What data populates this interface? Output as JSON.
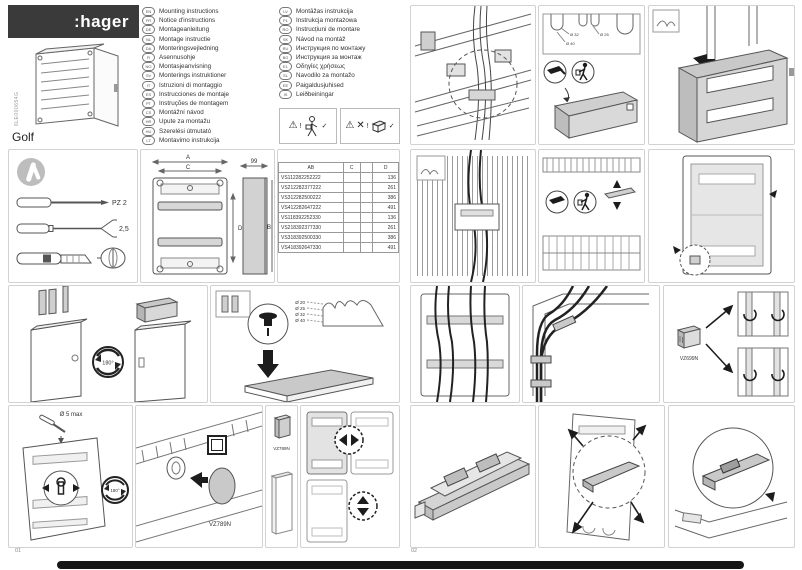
{
  "page": {
    "left_number": "01",
    "right_number": "02"
  },
  "brand": {
    "logo": ":hager",
    "product": "Golf",
    "doc_code": "6LE000654G"
  },
  "languages_col1": [
    {
      "code": "EN",
      "label": "Mounting instructions"
    },
    {
      "code": "FR",
      "label": "Notice d'instructions"
    },
    {
      "code": "DE",
      "label": "Montageanleitung"
    },
    {
      "code": "NL",
      "label": "Montage instructie"
    },
    {
      "code": "DA",
      "label": "Monteringsvejledning"
    },
    {
      "code": "FI",
      "label": "Asennusohje"
    },
    {
      "code": "NO",
      "label": "Montasjeanvisning"
    },
    {
      "code": "SV",
      "label": "Monterings instruktioner"
    },
    {
      "code": "IT",
      "label": "Istruzioni di montaggio"
    },
    {
      "code": "ES",
      "label": "Instrucciones de montaje"
    },
    {
      "code": "PT",
      "label": "Instruções de montagem"
    },
    {
      "code": "CS",
      "label": "Montážní návod"
    },
    {
      "code": "HR",
      "label": "Upute za montažu"
    },
    {
      "code": "HU",
      "label": "Szerelési útmutató"
    },
    {
      "code": "LT",
      "label": "Montavimo instrukcija"
    }
  ],
  "languages_col2": [
    {
      "code": "LV",
      "label": "Montāžas instrukcija"
    },
    {
      "code": "PL",
      "label": "Instrukcja montażowa"
    },
    {
      "code": "RO",
      "label": "Instrucțiuni de montare"
    },
    {
      "code": "SK",
      "label": "Návod na montáž"
    },
    {
      "code": "RU",
      "label": "Инструкция по монтажу"
    },
    {
      "code": "BG",
      "label": "Инструкция за монтаж"
    },
    {
      "code": "EL",
      "label": "Οδηγίες χρήσεως"
    },
    {
      "code": "SL",
      "label": "Navodilo za montažo"
    },
    {
      "code": "EE",
      "label": "Paigaldusjuhised"
    },
    {
      "code": "IS",
      "label": "Leiðbeiningar"
    }
  ],
  "warnings": {
    "triangle": "⚠",
    "check": "✓",
    "cross": "✕",
    "excl": "!"
  },
  "tools": {
    "pozidriv_label": "PZ 2",
    "flat_label": "2,5"
  },
  "dimensions": {
    "a": "A",
    "b": "B",
    "c": "C",
    "d": "D",
    "depth": "99"
  },
  "table": {
    "headers": {
      "col1": "AB",
      "col2": "C",
      "col3": "",
      "col4": "D"
    },
    "rows": [
      {
        "ref": "VS112282252222",
        "c": "",
        "d": "136"
      },
      {
        "ref": "VS212282377222",
        "c": "",
        "d": "261"
      },
      {
        "ref": "VS312282500222",
        "c": "",
        "d": "386"
      },
      {
        "ref": "VS412282647222",
        "c": "",
        "d": "491"
      },
      {
        "ref": "VS118392252330",
        "c": "",
        "d": "136"
      },
      {
        "ref": "VS218392377330",
        "c": "",
        "d": "261"
      },
      {
        "ref": "VS318392500330",
        "c": "",
        "d": "386"
      },
      {
        "ref": "VS418392647330",
        "c": "",
        "d": "491"
      }
    ]
  },
  "steps": {
    "rotate_label": "180°",
    "drill_label": "Ø 5 max",
    "accessory_vz789n": "VZ789N",
    "accessory_vz699n": "VZ699N",
    "knockout_sizes": [
      "Ø 20",
      "Ø 25",
      "Ø 32",
      "Ø 40"
    ],
    "knockout_strip_labels": [
      "Ø 32",
      "Ø 40",
      "Ø 25"
    ]
  }
}
